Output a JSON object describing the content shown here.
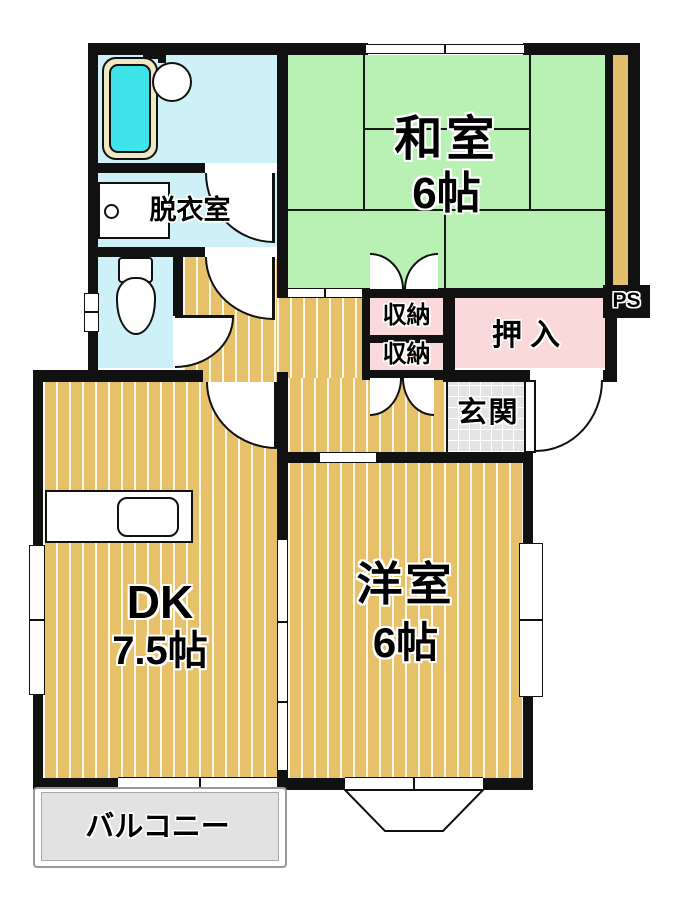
{
  "plan": {
    "rooms": {
      "washitsu": {
        "name": "和室",
        "size": "6帖"
      },
      "youshitsu": {
        "name": "洋室",
        "size": "6帖"
      },
      "dk": {
        "name": "DK",
        "size": "7.5帖"
      },
      "dressing_room": {
        "name": "脱衣室"
      },
      "oshiire": {
        "name": "押入"
      },
      "closet_upper": {
        "name": "収納"
      },
      "closet_lower": {
        "name": "収納"
      },
      "genkan": {
        "name": "玄関"
      },
      "balcony": {
        "name": "バルコニー"
      },
      "pipe_space": {
        "name": "PS"
      }
    },
    "colors": {
      "wall": "#111111",
      "tatami_green": "#b9f0b4",
      "wood_floor_tan": "#e6c169",
      "wet_area_cyan": "#cdf1f6",
      "bathtub_cyan": "#3fe4ea",
      "closet_pink": "#f9d9d9",
      "entry_tile_gray": "#e4e4e4",
      "balcony_gray": "#e2e2e2"
    },
    "fixtures": {
      "bathtub": "bathtub-icon",
      "washbasin": "washbasin-icon",
      "washing_machine": "washing-machine-icon",
      "toilet": "toilet-icon",
      "kitchen_sink": "kitchen-sink-icon"
    }
  }
}
